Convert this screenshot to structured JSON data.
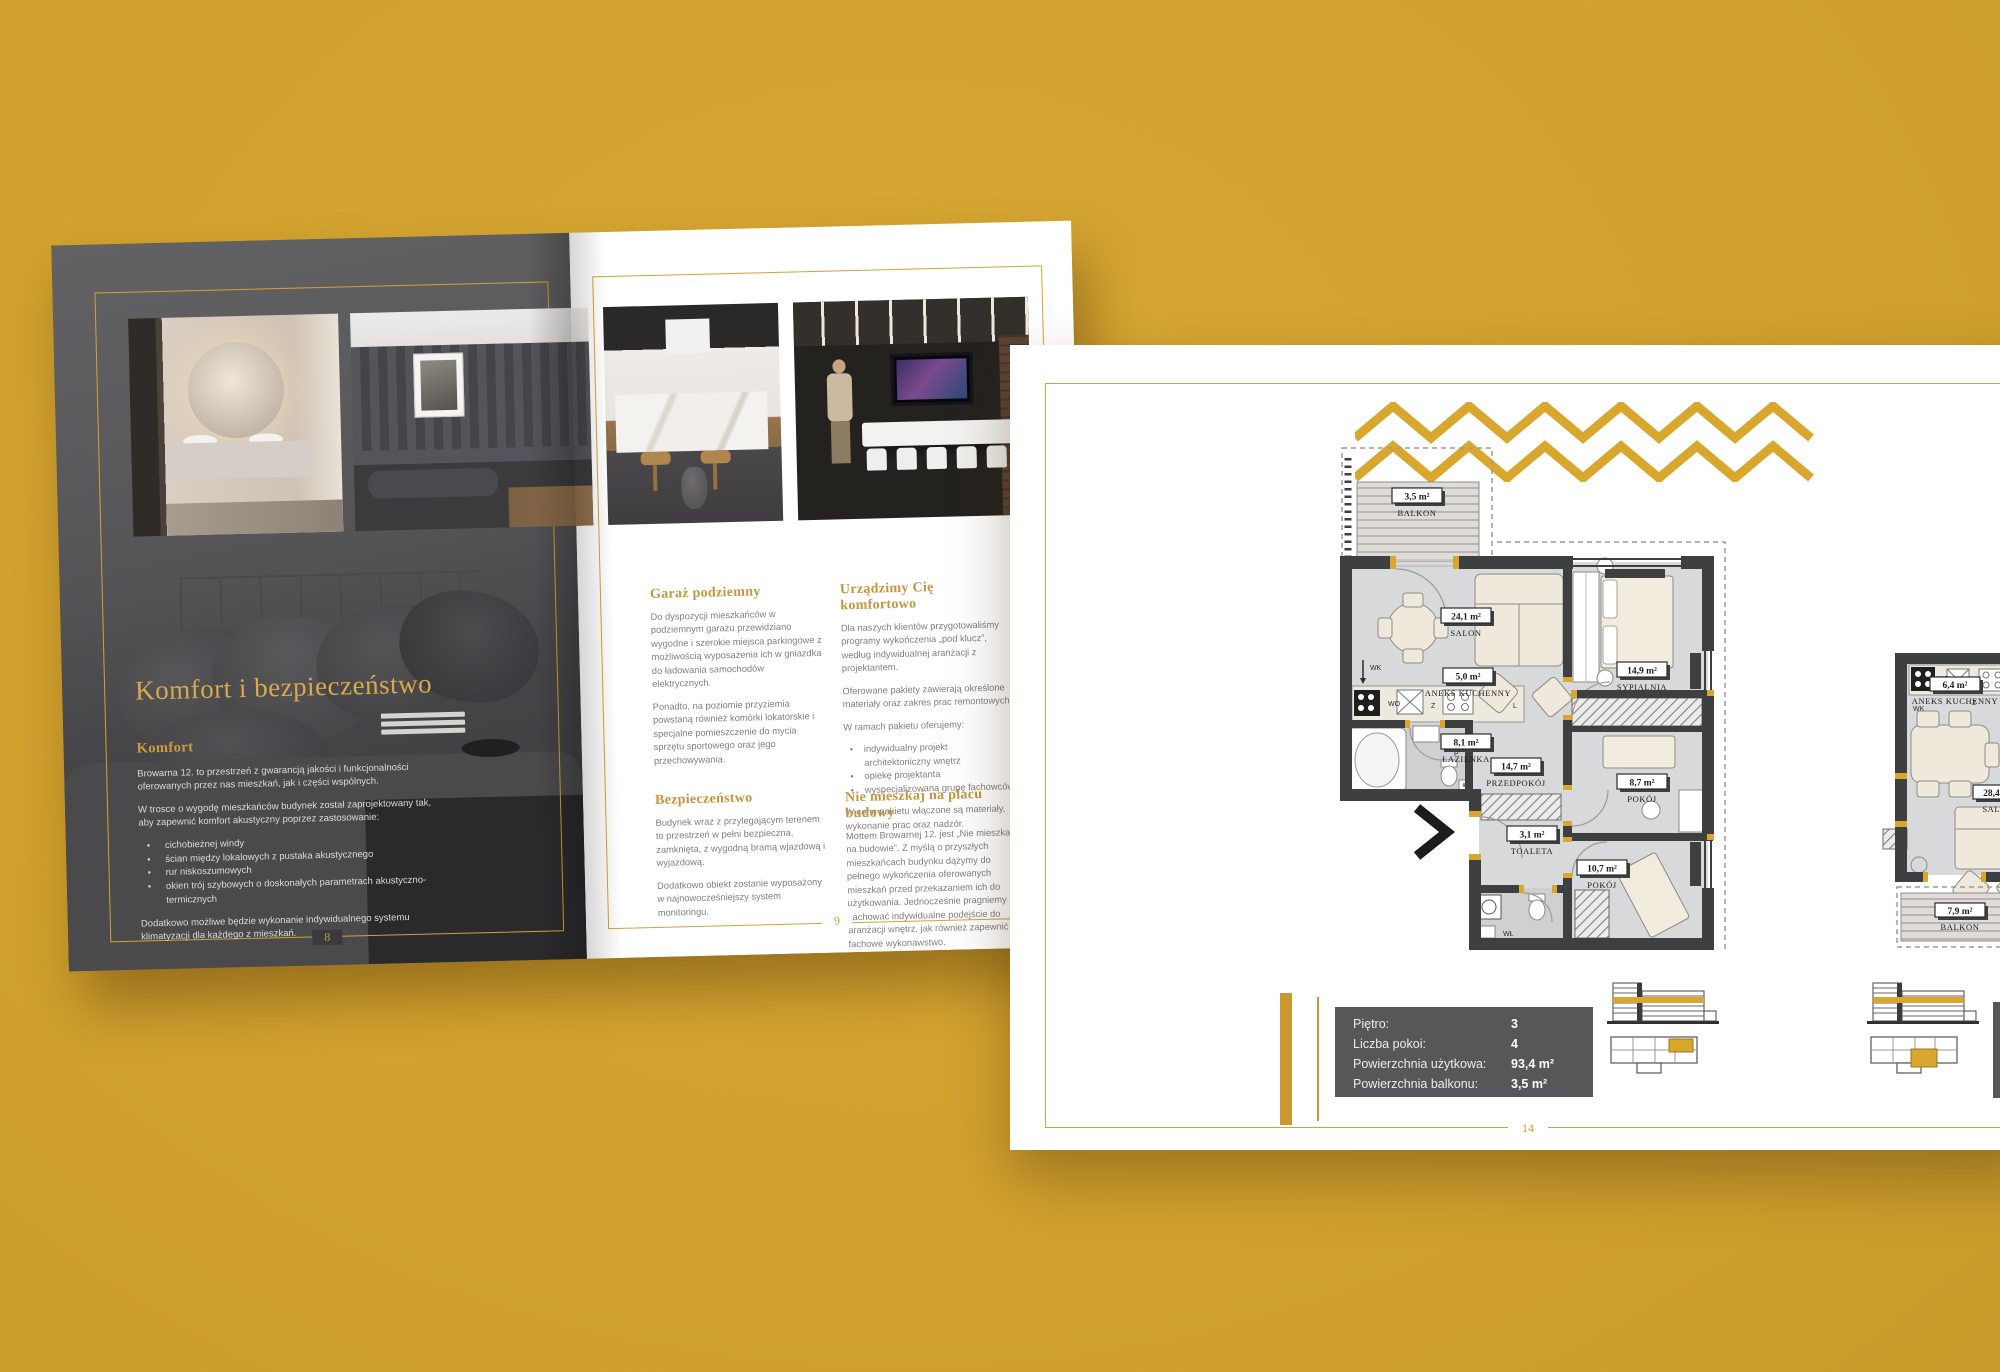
{
  "spread_left_page": {
    "page_number": "8",
    "title": "Komfort i bezpieczeństwo",
    "heading": "Komfort",
    "p1": "Browarna 12. to przestrzeń z gwarancją jakości i funkcjonalności oferowanych przez nas mieszkań, jak i części wspólnych.",
    "p2": "W trosce o wygodę mieszkańców budynek został zaprojektowany tak, aby zapewnić komfort akustyczny poprzez zastosowanie:",
    "bullets": [
      "cichobieżnej windy",
      "ścian między lokalowych z pustaka akustycznego",
      "rur niskoszumowych",
      "okien trój szybowych o doskonałych parametrach akustyczno-termicznych"
    ],
    "p3": "Dodatkowo możliwe będzie wykonanie indywidualnego systemu klimatyzacji dla każdego z mieszkań."
  },
  "spread_right_page": {
    "page_number": "9",
    "col1": {
      "h1": "Garaż podziemny",
      "p1": "Do dyspozycji mieszkańców w podziemnym garażu przewidziano wygodne i szerokie miejsca parkingowe z możliwością wyposażenia ich w gniazdka do ładowania samochodów elektrycznych.",
      "p2": "Ponadto, na poziomie przyziemia powstaną również komórki lokatorskie i specjalne pomieszczenie do mycia sprzętu sportowego oraz jego przechowywania.",
      "h2": "Bezpieczeństwo",
      "p3": "Budynek wraz z przylegającym terenem to przestrzeń w pełni bezpieczna, zamknięta, z wygodną bramą wjazdową i wyjazdową.",
      "p4": "Dodatkowo obiekt zostanie wyposażony w najnowocześniejszy system monitoringu."
    },
    "col2": {
      "h1": "Urządzimy Cię komfortowo",
      "p1": "Dla naszych klientów przygotowaliśmy programy wykończenia „pod klucz”, według indywidualnej aranżacji z projektantem.",
      "p2": "Oferowane pakiety zawierają określone materiały oraz zakres prac remontowych.",
      "p3": "W ramach pakietu oferujemy:",
      "bullets": [
        "indywidualny projekt architektoniczny wnętrz",
        "opiekę projektanta",
        "wyspecjalizowaną grupę fachowców"
      ],
      "p4": "W cenę pakietu włączone są materiały, wykonanie prac oraz nadzór.",
      "h2": "Nie mieszkaj na placu budowy",
      "p5": "Mottem Browarnej 12. jest „Nie mieszkaj na budowie”. Z myślą o przyszłych mieszkańcach budynku dążymy do pełnego wykończenia oferowanych mieszkań przed przekazaniem ich do użytkowania. Jednocześnie pragniemy zachować indywidualne podejście do aranżacji wnętrz, jak również zapewnić fachowe wykonawstwo."
    }
  },
  "page14": {
    "page_number": "14",
    "info_table": {
      "rows": [
        {
          "label": "Piętro:",
          "value": "3"
        },
        {
          "label": "Liczba pokoi:",
          "value": "4"
        },
        {
          "label": "Powierzchnia użytkowa:",
          "value": "93,4 m²"
        },
        {
          "label": "Powierzchnia balkonu:",
          "value": "3,5 m²"
        }
      ]
    },
    "plan1": {
      "rooms": [
        {
          "area": "3,5 m²",
          "name": "BALKON"
        },
        {
          "area": "24,1 m²",
          "name": "SALON"
        },
        {
          "area": "5,0 m²",
          "name": "ANEKS KUCHENNY"
        },
        {
          "area": "14,9 m²",
          "name": "SYPIALNIA"
        },
        {
          "area": "8,1 m²",
          "name": "ŁAZIENKA"
        },
        {
          "area": "14,7 m²",
          "name": "PRZEDPOKÓJ"
        },
        {
          "area": "3,1 m²",
          "name": "TOALETA"
        },
        {
          "area": "8,7 m²",
          "name": "POKÓJ"
        },
        {
          "area": "10,7 m²",
          "name": "POKÓJ"
        }
      ],
      "markers": {
        "wk": "WK",
        "wo": "WO",
        "z": "Z",
        "l": "L",
        "p": "P",
        "wl": "WŁ"
      }
    },
    "plan2": {
      "rooms": [
        {
          "area": "6,4 m²",
          "name": "ANEKS KUCHENNY"
        },
        {
          "area": "28,4 m²",
          "name": "SALON"
        },
        {
          "area": "7,9 m²",
          "name": "BALKON"
        }
      ],
      "markers": {
        "wk": "WK",
        "wo": "WO",
        "z": "Z"
      }
    }
  },
  "colors": {
    "background": "#D4A42F",
    "gold": "#D9A62E",
    "gold_text": "#C5953A",
    "page_dark": "#59595B",
    "info_panel": "#57575A"
  }
}
